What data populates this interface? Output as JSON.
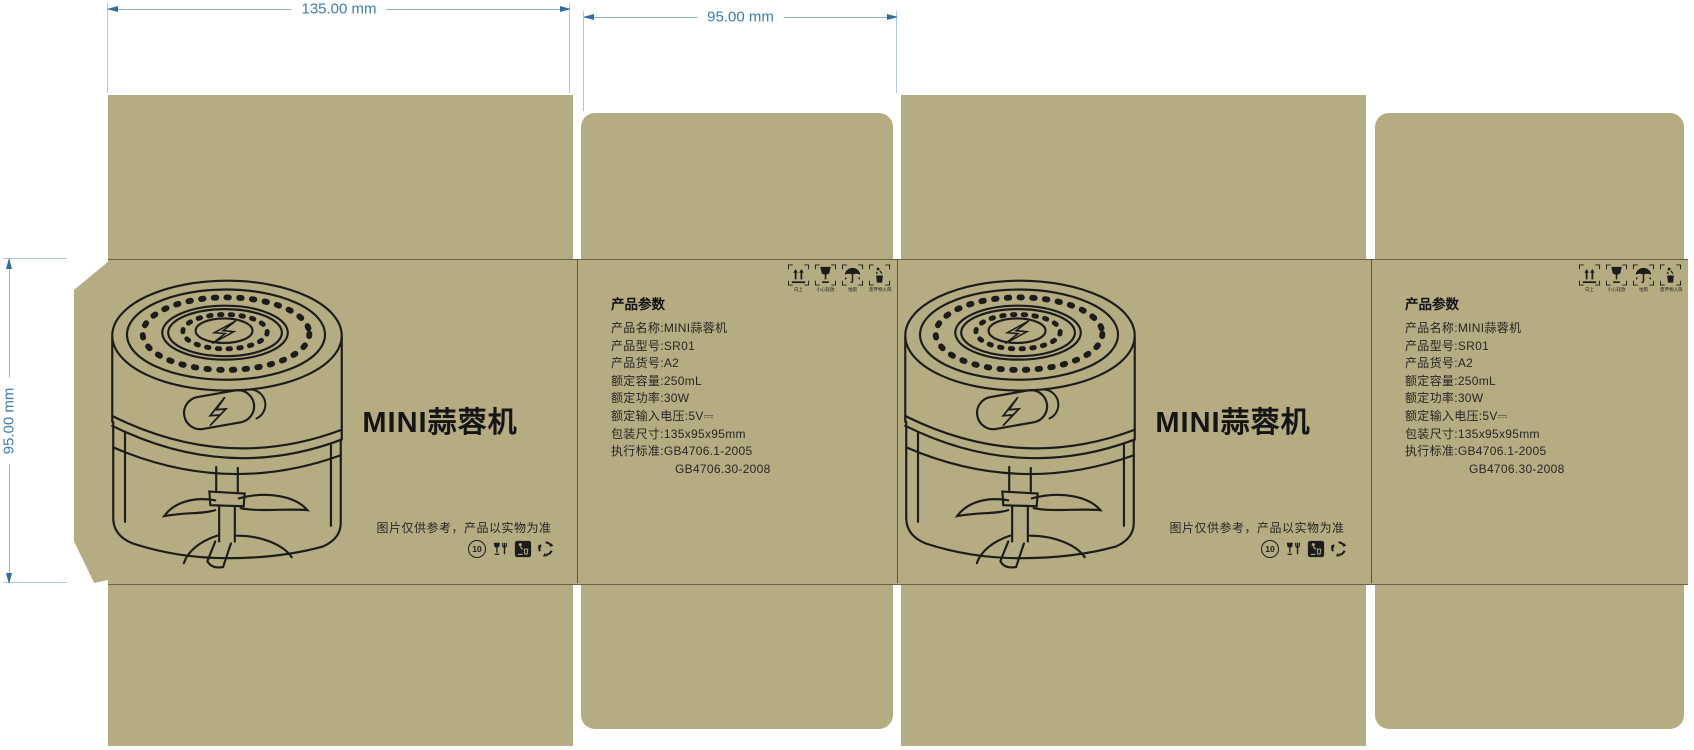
{
  "dimensions": {
    "top_width": "135.00 mm",
    "top_side": "95.00 mm",
    "left_height": "95.00 mm"
  },
  "front_panel": {
    "title": "MINI蒜蓉机",
    "disclaimer": "图片仅供参考，产品以实物为准",
    "illustration": "mini-garlic-chopper-line-drawing",
    "cert_icons": [
      {
        "name": "environment-period-icon",
        "value": "10"
      },
      {
        "name": "food-contact-safe-icon"
      },
      {
        "name": "tidy-man-icon"
      },
      {
        "name": "recycle-icon"
      }
    ]
  },
  "side_panel": {
    "params_title": "产品参数",
    "params": [
      "产品名称:MINI蒜蓉机",
      "产品型号:SR01",
      "产品货号:A2",
      "额定容量:250mL",
      "额定功率:30W",
      "额定输入电压:5V⎓",
      "包装尺寸:135x95x95mm",
      "执行标准:GB4706.1-2005",
      "GB4706.30-2008"
    ],
    "handling_icons": [
      {
        "name": "this-way-up-icon",
        "label": "向上"
      },
      {
        "name": "fragile-icon",
        "label": "小心轻放"
      },
      {
        "name": "keep-dry-icon",
        "label": "怕雨"
      },
      {
        "name": "litter-disposal-icon",
        "label": "废弃物入筒"
      }
    ]
  },
  "colors": {
    "board": "#b6ac81",
    "ink": "#1c1c1c",
    "fold_line": "#3e3e2c",
    "dim_line": "#8ab4d8",
    "dim_text": "#3c7bb0"
  }
}
